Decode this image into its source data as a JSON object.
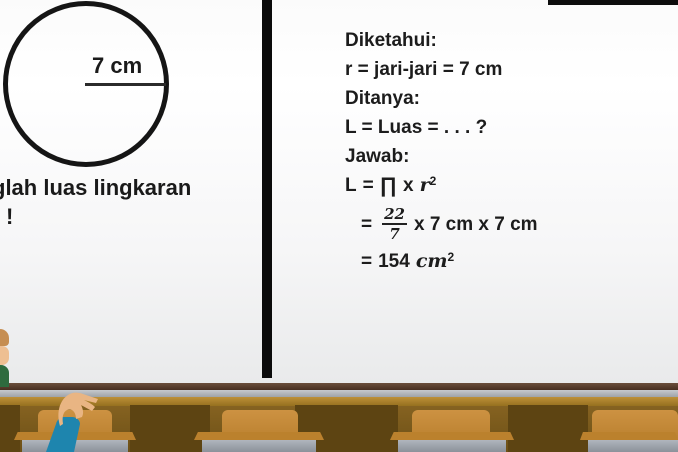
{
  "scene": {
    "description": "math-lesson-video-frame",
    "topic": "luas-lingkaran"
  },
  "board": {
    "left_panel": {
      "figure": {
        "shape": "circle",
        "radius_label": "7 cm"
      },
      "question_line1": "glah luas lingkaran",
      "question_line2": "!"
    },
    "right_panel": {
      "lines": [
        {
          "text": "Diketahui:"
        },
        {
          "text": "r = jari-jari = 7 cm"
        },
        {
          "text": "Ditanya:"
        },
        {
          "text": "L = Luas = . . . ?"
        },
        {
          "text": "Jawab:"
        }
      ],
      "formula": {
        "line1": {
          "lhs": "L",
          "eq": "=",
          "pi": "∏",
          "times": "x",
          "var": "r",
          "power": "2"
        },
        "line2": {
          "eq": "=",
          "frac_num": "22",
          "frac_den": "7",
          "rest": "x 7 cm x 7 cm"
        },
        "line3": {
          "eq": "=",
          "value": "154",
          "unit": "cm",
          "power": "2"
        }
      }
    }
  },
  "colors": {
    "divider_black": "#0b0b0b",
    "board_light": "#f6f6f7",
    "tray_brown": "#4f3827",
    "tray_gray": "#b2b5b9",
    "classroom_brown": "#7c5c1e",
    "chair_orange": "#c4883a",
    "desk_gray": "#a2a8b0",
    "sleeve_blue": "#1e85ae",
    "skin": "#e9b583",
    "teacher_green": "#2e6b3e",
    "text_black": "#1c1c1c"
  }
}
